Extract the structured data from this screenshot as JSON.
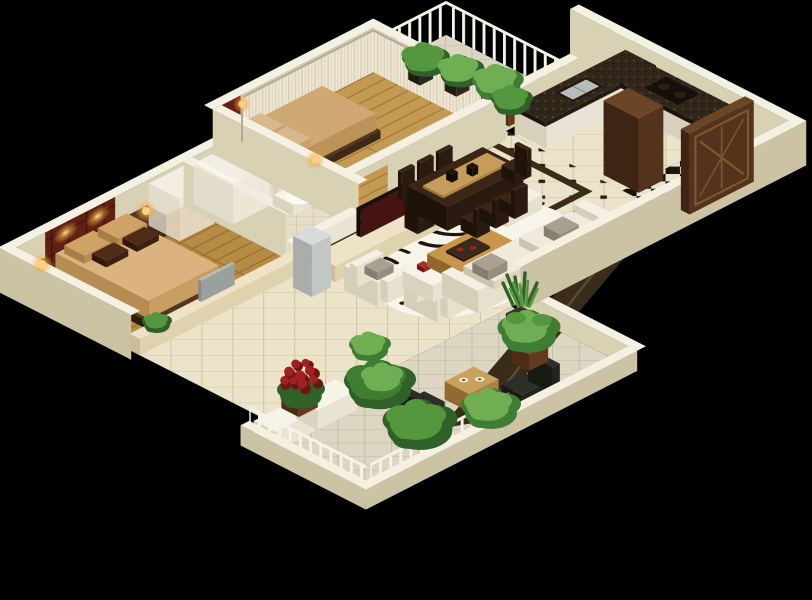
{
  "scene": {
    "title": "3D isometric apartment floor plan render",
    "background": "#000000",
    "rooms": [
      {
        "name": "master-bedroom",
        "floor": "golden-wood-planks",
        "items": [
          "tufted-maroon-headboard-wall",
          "wall-lamps-lit",
          "double-bed",
          "tan-pillows",
          "brown-accent-pillows",
          "nightstand-left",
          "nightstand-right",
          "glowing-table-lamps",
          "translucent-white-wardrobe",
          "low-divider-wall-with-ledge",
          "gray-monitor-on-ledge",
          "small-plant"
        ]
      },
      {
        "name": "bathroom",
        "floor": "small-diamond-beige-tile",
        "items": [
          "translucent-shower-enclosure",
          "white-toilet",
          "low-partition-wall"
        ]
      },
      {
        "name": "second-bedroom",
        "floor": "golden-wood-planks",
        "items": [
          "dark-red-upholstered-headboard",
          "double-bed-tan-bedding",
          "white-nightstand",
          "glowing-gold-lamp",
          "floor-lamp",
          "sheer-curtain-wall-north",
          "sheer-curtain-wall-east"
        ]
      },
      {
        "name": "plant-balcony",
        "floor": "grey-stone-tile",
        "items": [
          "white-picket-railing",
          "potted-plants-x4"
        ]
      },
      {
        "name": "dining-room",
        "floor": "cream-tile-with-black-diamond-inlay",
        "items": [
          "dark-marble-border",
          "espresso-dining-table",
          "tan-table-runner",
          "vases",
          "dining-chairs-x6"
        ]
      },
      {
        "name": "kitchen",
        "floor": "cream-diamond-tile",
        "items": [
          "l-shaped-granite-counter",
          "stainless-sink",
          "black-cooktop",
          "white-cabinet-fronts",
          "tall-walnut-cabinet"
        ]
      },
      {
        "name": "entry-hall",
        "floor": "black-white-checker-with-star",
        "items": [
          "carved-walnut-door"
        ]
      },
      {
        "name": "living-room",
        "floor": "cream-diamond-tile",
        "items": [
          "cream-tv-stand",
          "flat-screen-tv-red-image",
          "silver-floor-ac-unit",
          "zebra-hide-rug",
          "wood-coffee-table",
          "white-tray-table",
          "red-tea-cups",
          "white-teapot",
          "white-sofa",
          "gray-throw-cushions",
          "armchairs-x2",
          "white-ottoman",
          "dark-marble-walkway",
          "potted-plant"
        ]
      },
      {
        "name": "terrace",
        "floor": "grey-diamond-tile",
        "items": [
          "white-parapet-with-railing",
          "planter-cabinets",
          "red-chrysanthemum-pot",
          "fern-cluster",
          "black-sling-chairs-x2",
          "wood-tea-table",
          "white-tea-cups",
          "broadleaf-plant-pot",
          "snake-plant-pot",
          "green-shrubs"
        ]
      }
    ],
    "palette": {
      "bg": "#000000",
      "wallCap": "#f5f1e2",
      "wallIn": "#d8d1b4",
      "wallOut": "#cbc3a4",
      "woodA": "#b68b43",
      "woodLineA": "#977135",
      "woodB": "#c49a52",
      "woodLineB": "#a37c3e",
      "tileBase": "#ece4ca",
      "tileLine": "#c9b98e",
      "tileDot": "#2a2012",
      "terraceTile": "#dcd6c2",
      "terraceLine": "#b6af97",
      "bathTile": "#e6deca",
      "checkerA": "#e9e3d3",
      "checkerB": "#18130d",
      "marble": "#3a2c1a",
      "walkVein": "#5d4830",
      "rugWhite": "#f7f4ea",
      "rugBlack": "#1b160f",
      "sofaTop": "#f4f0e3",
      "sofaFace": "#e6e0cd",
      "sofaSide": "#d5cfb8",
      "cushion": "#a9a092",
      "creamTop": "#eee3c6",
      "creamFace": "#dfd2ae",
      "creamSide": "#cbbd97",
      "woodTableA": "#c8964a",
      "woodTableB": "#ab7c38",
      "woodTableC": "#8f662c",
      "espressoA": "#3a2517",
      "espressoB": "#2b1a0f",
      "espressoC": "#1f1209",
      "runner": "#c69c5a",
      "graniteTop": "#30261a",
      "graniteFace": "#e8e3d4",
      "graniteSide": "#d6d0bd",
      "steel": "#b8bcbb",
      "cooktop": "#15100b",
      "doorA": "#6b4526",
      "doorB": "#54331c",
      "doorC": "#3e2413",
      "doorLine": "#7d5530",
      "maroon": "#5f2114",
      "maroonLine": "#3c1109",
      "bedTop": "#dcb27e",
      "bedFace": "#c99e63",
      "bedSide": "#b78c52",
      "pillowTan": "#cfa265",
      "pillowBrown": "#4e2d18",
      "bed2Top": "#cfa873",
      "bed2Face": "#bd9257",
      "bed2Side": "#a87f46",
      "frameA": "#52381f",
      "frameB": "#3e2914",
      "frameC": "#2e1d0d",
      "whiteTop": "#f6f3e8",
      "whiteFace": "#e8e3d3",
      "whiteSide": "#d9d3bf",
      "glassTop": "#f8f6ef",
      "glassFace": "#efecdf",
      "glassSide": "#e4e0d0",
      "acTop": "#d8dbd7",
      "acFace": "#c3c7c3",
      "acSide": "#a9aeaa",
      "tvDark": "#16110c",
      "tvScreen": "#451311",
      "grayTvA": "#b8bcb8",
      "grayTvB": "#9aa09b",
      "grayTvC": "#878d88",
      "lampCore": "#ffcf7e",
      "curtain": "#efe8d6",
      "curtainLine": "#dcd2b8",
      "rod": "#b3ab96",
      "rail": "#f6f3e8",
      "potA": "#7c4c28",
      "potB": "#653a1d",
      "potC": "#4e2b14",
      "potDarkA": "#3c342a",
      "potDarkB": "#2d261e",
      "potDarkC": "#201a14",
      "green1": "#2f6128",
      "green2": "#3f7d33",
      "green3": "#55973f",
      "green4": "#6fae52",
      "flowerRed": "#9e2124",
      "flowerDark": "#6e1414",
      "chairA": "#2c2e27",
      "chairB": "#22241e",
      "chairC": "#171913",
      "headboard2A": "#6e2416",
      "headboard2B": "#54160c",
      "headboard2C": "#3e0f07",
      "tanWoodA": "#c9a05c",
      "tanWoodB": "#ad8343",
      "tanWoodC": "#906a33"
    }
  }
}
